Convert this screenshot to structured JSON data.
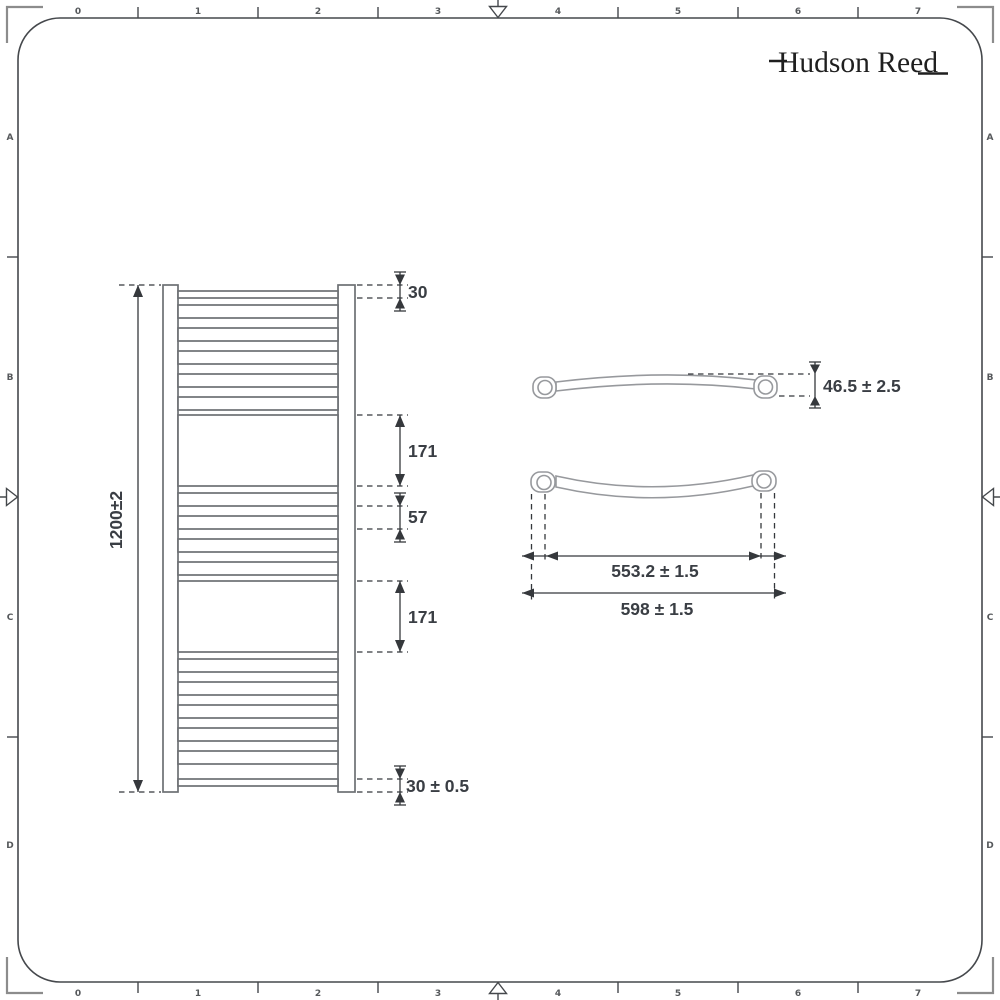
{
  "brand": {
    "logo": "Hudson Reed"
  },
  "frame": {
    "top_ruler": [
      "0",
      "1",
      "2",
      "3",
      "4",
      "5",
      "6",
      "7"
    ],
    "bottom_ruler": [
      "0",
      "1",
      "2",
      "3",
      "4",
      "5",
      "6",
      "7"
    ],
    "left_rows": [
      "A",
      "B",
      "C",
      "D"
    ],
    "right_rows": [
      "A",
      "B",
      "C",
      "D"
    ]
  },
  "front_view": {
    "height_dim": "1200±2",
    "top_offset_dim": "30",
    "upper_section_dim": "171",
    "bar_pitch_dim": "57",
    "lower_section_dim": "171",
    "bottom_offset_dim": "30 ± 0.5"
  },
  "top_view": {
    "depth_dim": "46.5 ± 2.5",
    "centres_dim": "553.2 ± 1.5",
    "overall_width_dim": "598 ± 1.5"
  },
  "colors": {
    "radiator_outline": "#6d7074",
    "detail_outline": "#97999d",
    "dimension": "#35383c",
    "frame": "#45484c",
    "corner_marks": "#8c8c8c",
    "label_text": "#3a3e44",
    "logo": "#1f1f1f",
    "background": "#ffffff"
  }
}
